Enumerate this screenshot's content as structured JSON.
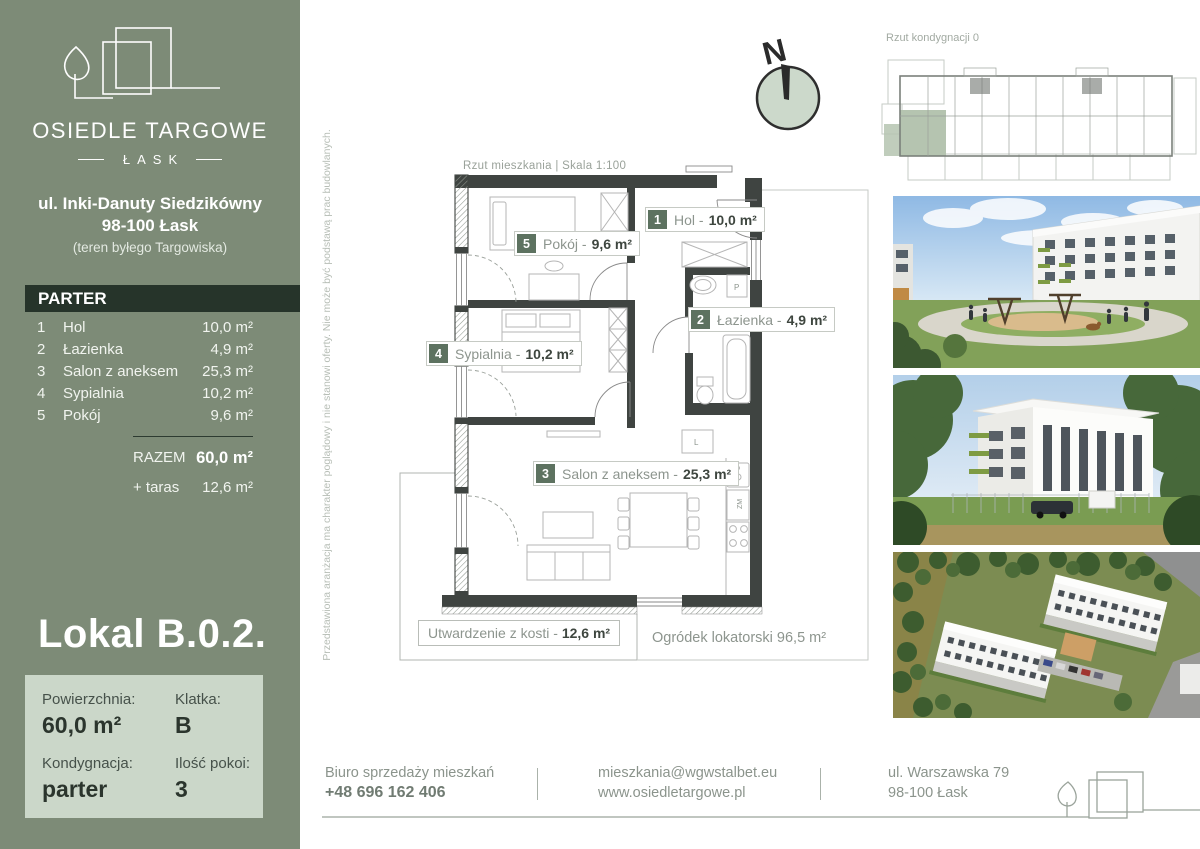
{
  "sidebar": {
    "brand_name": "OSIEDLE TARGOWE",
    "brand_sub": "ŁASK",
    "address_line1": "ul. Inki-Danuty Siedzikówny",
    "address_line2": "98-100 Łask",
    "address_note": "(teren byłego Targowiska)",
    "floor_header": "PARTER",
    "rooms": [
      {
        "no": "1",
        "name": "Hol",
        "area": "10,0 m²"
      },
      {
        "no": "2",
        "name": "Łazienka",
        "area": "4,9 m²"
      },
      {
        "no": "3",
        "name": "Salon z aneksem",
        "area": "25,3 m²"
      },
      {
        "no": "4",
        "name": "Sypialnia",
        "area": "10,2 m²"
      },
      {
        "no": "5",
        "name": "Pokój",
        "area": "9,6 m²"
      }
    ],
    "total_label": "RAZEM",
    "total_area": "60,0 m²",
    "terrace_label": "+ taras",
    "terrace_area": "12,6 m²",
    "unit_title": "Lokal B.0.2.",
    "info": {
      "area_label": "Powierzchnia:",
      "area_value": "60,0 m²",
      "staircase_label": "Klatka:",
      "staircase_value": "B",
      "floor_label": "Kondygnacja:",
      "floor_value": "parter",
      "rooms_label": "Ilość pokoi:",
      "rooms_value": "3"
    }
  },
  "plan": {
    "caption": "Rzut mieszkania  |  Skala 1:100",
    "disclaimer": "Przedstawiona aranżacja ma charakter poglądowy i nie stanowi oferty. Nie może być podstawą prac budowlanych.",
    "compass_label": "N",
    "labels": [
      {
        "no": "1",
        "name": "Hol -",
        "area": "10,0 m²"
      },
      {
        "no": "2",
        "name": "Łazienka -",
        "area": "4,9 m²"
      },
      {
        "no": "3",
        "name": "Salon z aneksem -",
        "area": "25,3 m²"
      },
      {
        "no": "4",
        "name": "Sypialnia -",
        "area": "10,2 m²"
      },
      {
        "no": "5",
        "name": "Pokój -",
        "area": "9,6 m²"
      }
    ],
    "paved_label": "Utwardzenie z kosti -",
    "paved_area": "12,6 m²",
    "garden_label": "Ogródek lokatorski 96,5 m²",
    "fixtures": {
      "washer": "P",
      "fridge": "L",
      "dishwasher": "ZM"
    }
  },
  "overview": {
    "caption": "Rzut kondygnacji 0"
  },
  "footer": {
    "office_label": "Biuro sprzedaży mieszkań",
    "phone": "+48 696 162 406",
    "email": "mieszkania@wgwstalbet.eu",
    "website": "www.osiedletargowe.pl",
    "address_line1": "ul. Warszawska 79",
    "address_line2": "98-100 Łask"
  },
  "colors": {
    "sidebar_green": "#7d8b77",
    "dark_header": "#26342a",
    "light_box": "#cbd7c9",
    "badge_green": "#5d7260",
    "wall_gray": "#3f4441",
    "highlight_unit_green": "#b5c4b0"
  }
}
